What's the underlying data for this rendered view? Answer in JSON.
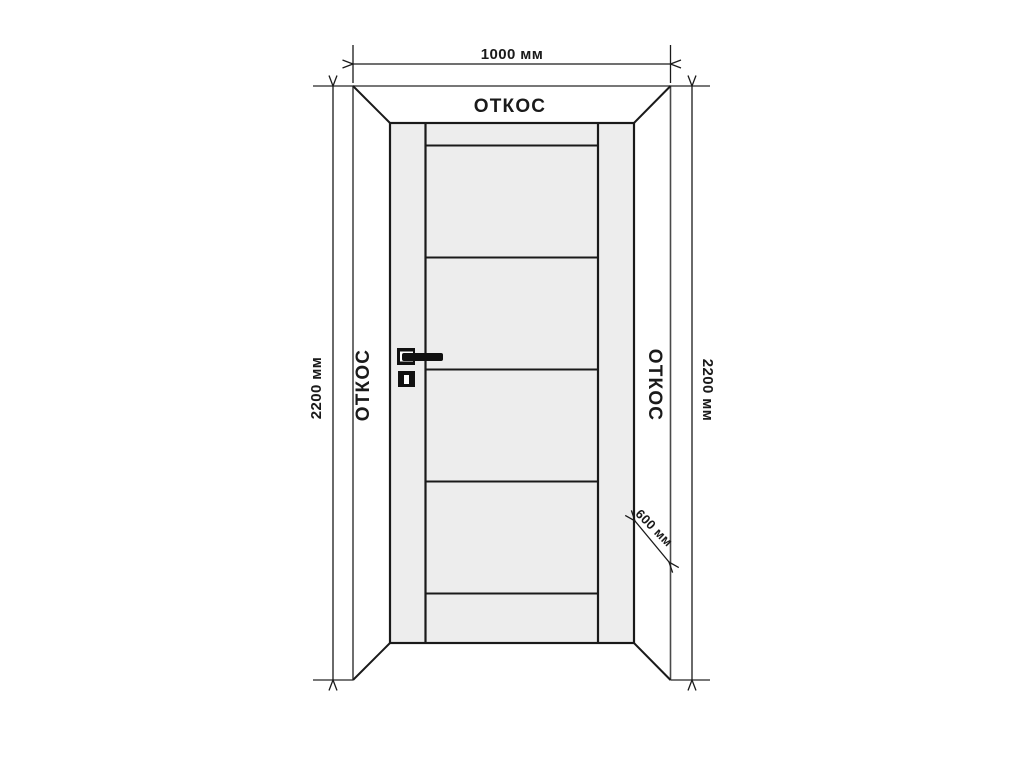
{
  "diagram": {
    "jamb_labels": {
      "top": "ОТКОС",
      "left": "ОТКОС",
      "right": "ОТКОС"
    },
    "dimensions": {
      "opening_width": "1000 мм",
      "opening_height_left": "2200 мм",
      "opening_height_right": "2200 мм",
      "jamb_depth": "600 мм"
    },
    "colors": {
      "background": "#ffffff",
      "line": "#1a1a1a",
      "wall_line": "#4a4a4a",
      "door_fill": "#ededed",
      "hardware": "#111111"
    }
  }
}
